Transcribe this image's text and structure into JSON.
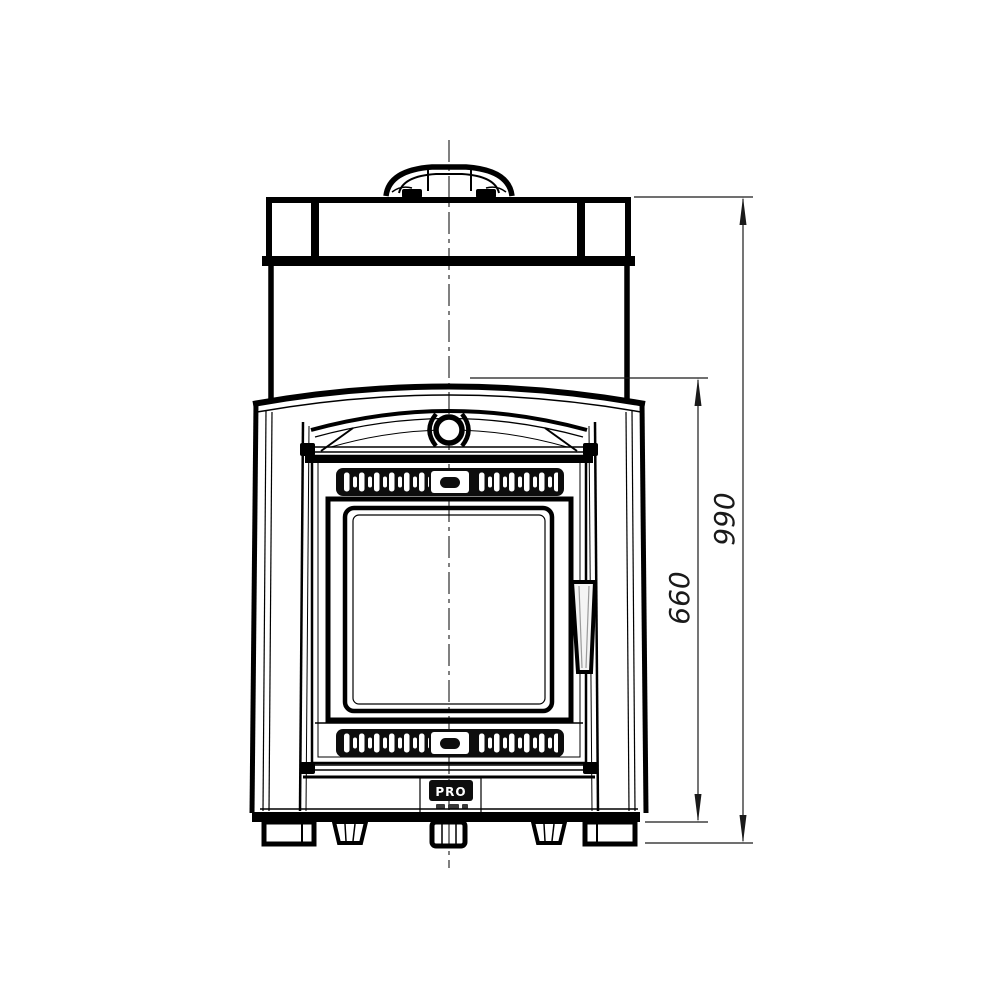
{
  "page": {
    "background": "#ffffff",
    "line_color": "#000000",
    "dimension_line_color": "#1a1a1a"
  },
  "drawing": {
    "subject": "front elevation technical drawing of a wood-burning sauna stove with glass door",
    "view": "front",
    "parts": [
      "chimney-collar",
      "top-cap",
      "heater-body",
      "hood-arch",
      "side-panel-left",
      "side-panel-right",
      "ornament-emblem",
      "upper-vent-grille",
      "fire-door",
      "door-glass",
      "door-handle",
      "lower-vent-grille",
      "ash-front-panel",
      "brand-badge",
      "base-plate",
      "feet",
      "center-axis-line"
    ]
  },
  "dimensions": [
    {
      "id": "overall-height",
      "value": "990"
    },
    {
      "id": "firebox-section-height",
      "value": "660"
    }
  ],
  "badge": {
    "text": "PRO"
  }
}
